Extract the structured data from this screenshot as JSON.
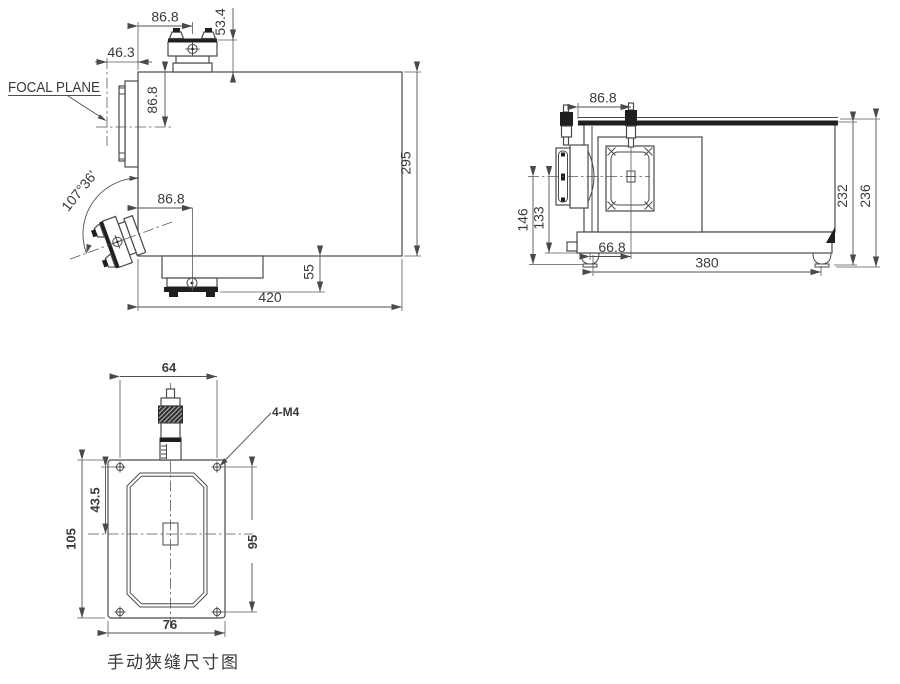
{
  "drawing": {
    "caption": "手动狭缝尺寸图",
    "colors": {
      "line": "#4a4a4a",
      "dark_fill": "#1f1f1f",
      "text": "#3a3a3a",
      "caption": "#8f8f8f",
      "background": "#ffffff"
    },
    "views": {
      "side": {
        "dims": {
          "top_slit_offset": "86.8",
          "slit_height": "53.4",
          "focal_offset": "46.3",
          "focal_plane_label": "FOCAL PLANE",
          "beam_height": "86.8",
          "entrance_angle": "107°36'",
          "bottom_slit_offset": "86.8",
          "body_height": "295",
          "base_height": "55",
          "body_length": "420"
        }
      },
      "front": {
        "dims": {
          "slit_offset": "86.8",
          "axis_to_base": "146",
          "axis_to_body": "133",
          "slit_axis_offset": "66.8",
          "mount_span": "380",
          "body_height": "232",
          "overall_height": "236"
        }
      },
      "slit_face": {
        "dims": {
          "hole_span_h": "64",
          "thread_callout": "4-M4",
          "center_offset": "43.5",
          "plate_height": "105",
          "hole_span_v": "95",
          "plate_width": "76"
        }
      }
    }
  }
}
